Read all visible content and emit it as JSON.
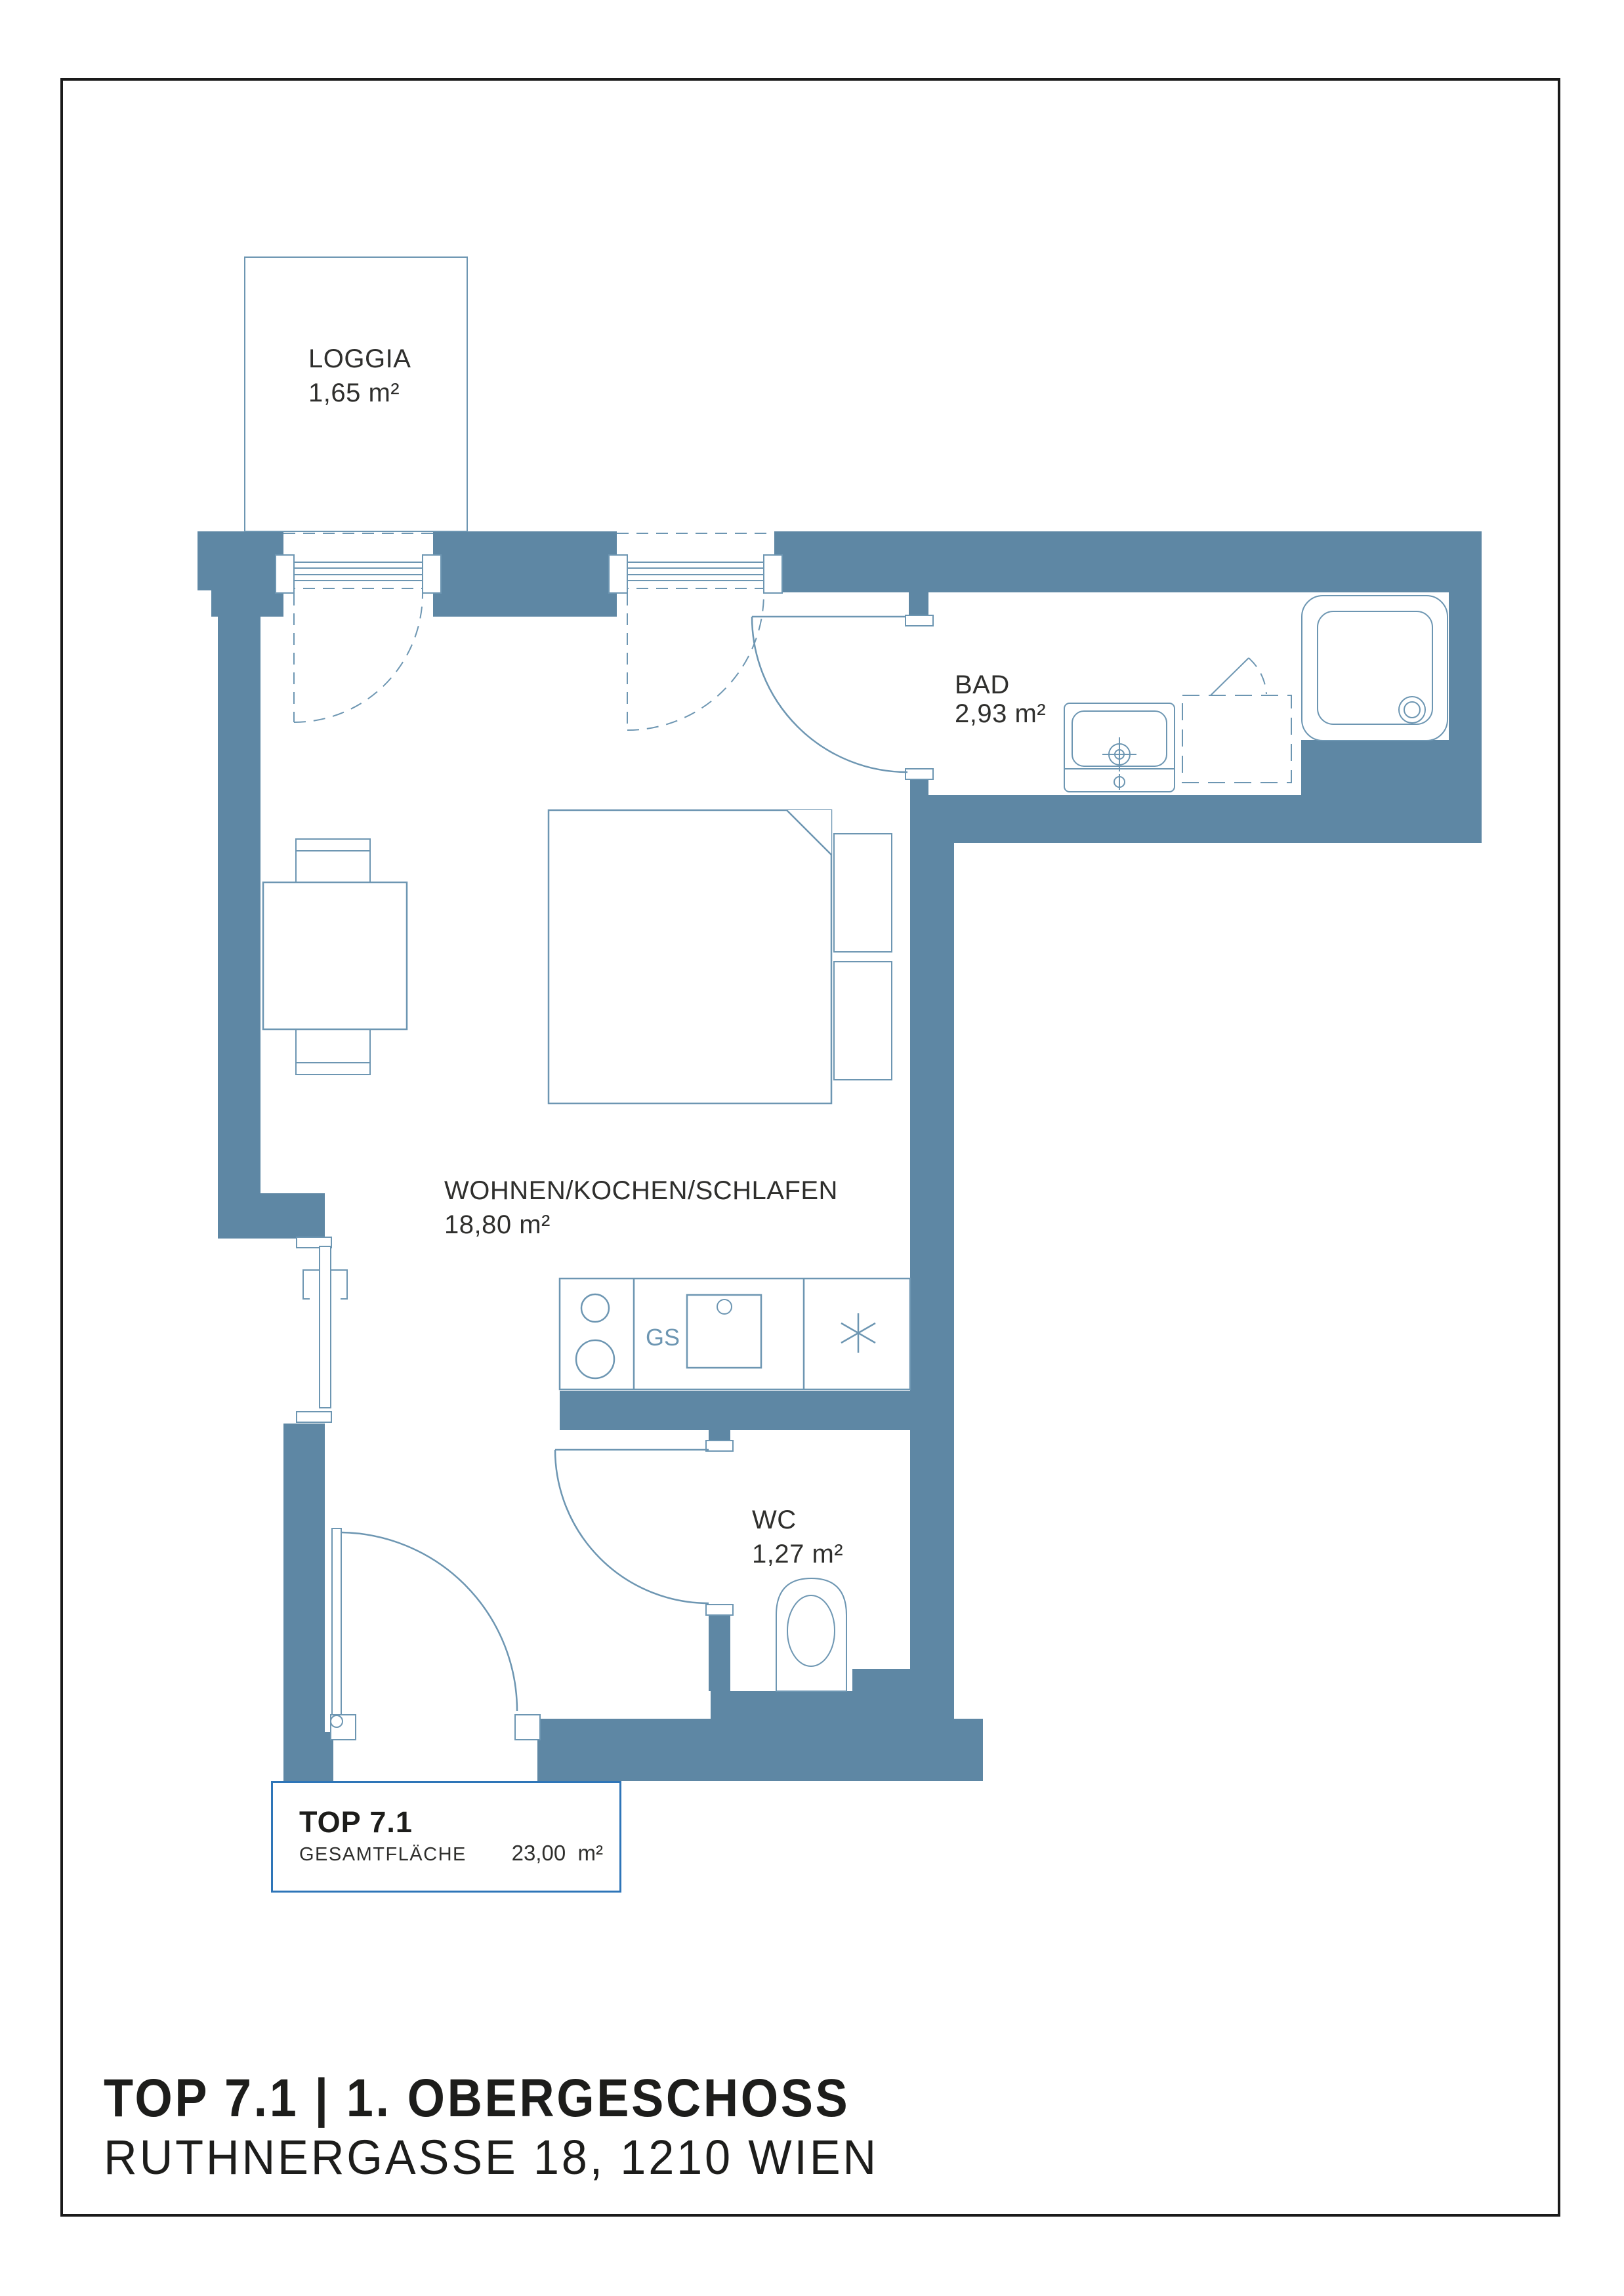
{
  "colors": {
    "wall": "#5e87a4",
    "line": "#6d96b2",
    "text": "#2f2f2d",
    "accent": "#2e75b8",
    "frame": "#1a1a1a"
  },
  "rooms": {
    "loggia": {
      "name": "LOGGIA",
      "area": "1,65 m²"
    },
    "bad": {
      "name": "BAD",
      "area": "2,93 m²"
    },
    "wohnen": {
      "name": "WOHNEN/KOCHEN/SCHLAFEN",
      "area": "18,80 m²"
    },
    "wc": {
      "name": "WC",
      "area": "1,27 m²"
    }
  },
  "kitchen": {
    "dishwasher_label": "GS"
  },
  "title_block": {
    "unit": "TOP 7.1",
    "total_label": "GESAMTFLÄCHE",
    "total_area": "23,00  m²"
  },
  "footer": {
    "title": "TOP 7.1 | 1. OBERGESCHOSS",
    "address": "RUTHNERGASSE 18, 1210 WIEN"
  }
}
